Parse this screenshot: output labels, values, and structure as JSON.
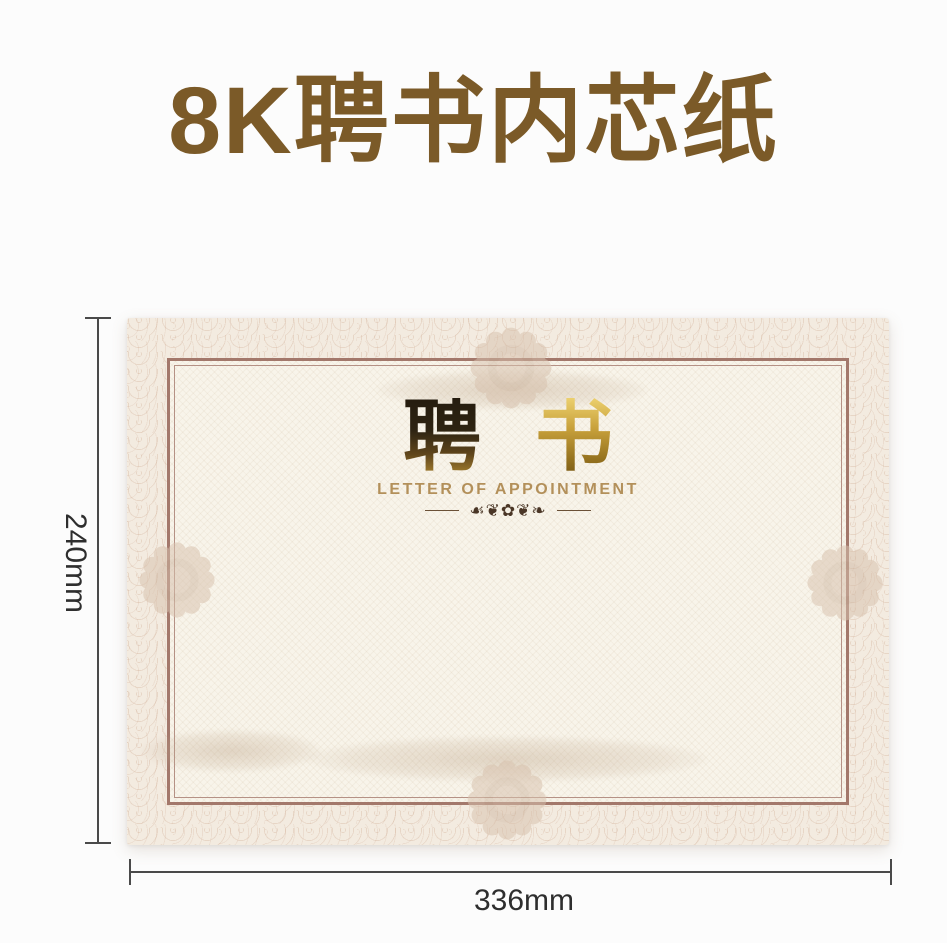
{
  "header": {
    "title": "8K聘书内芯纸"
  },
  "certificate": {
    "title_char_1": "聘",
    "title_char_2": "书",
    "subtitle": "LETTER OF APPOINTMENT",
    "ornament": "☙❦✿❦❧"
  },
  "dimensions": {
    "height_label": "240mm",
    "width_label": "336mm"
  },
  "colors": {
    "title_brown": "#7b5a28",
    "paper_cream": "#f3ebe0",
    "inner_cream": "#f8f4ea",
    "frame_brown": "#a3786b",
    "guilloche_tan": "#ceaa90",
    "gold_text": "#b3905a",
    "foil_gold": "#c9a23c",
    "dimension_line": "#4a4a4a",
    "dimension_text": "#2e2e2e"
  }
}
